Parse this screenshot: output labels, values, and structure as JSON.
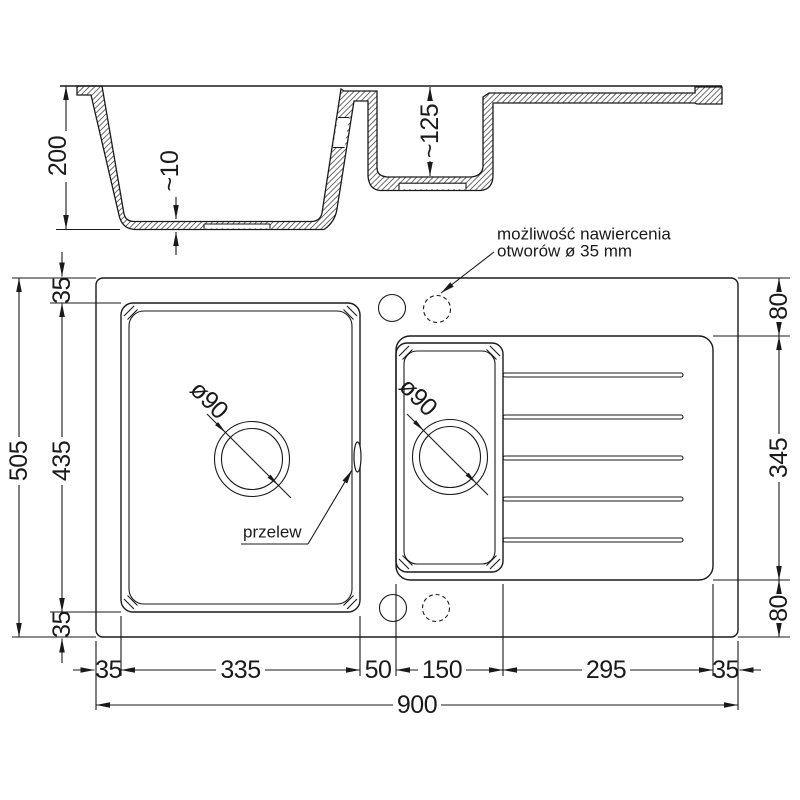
{
  "drawing_title": "sink-technical-drawing",
  "section": {
    "dim_depth": "200",
    "dim_bottom_thickness": "~10",
    "dim_small_bowl_depth": "~125",
    "note": {
      "line1": "możliwość nawiercenia",
      "line2": "otworów ø 35 mm"
    }
  },
  "plan": {
    "dim_height_total": "505",
    "dim_bowl_height": "435",
    "dim_rim_top": "35",
    "dim_rim_bottom": "35",
    "dim_right_top": "80",
    "dim_drainer_height": "345",
    "dim_right_bottom": "80",
    "dim_bottom_row": [
      "35",
      "335",
      "50",
      "150",
      "295",
      "35"
    ],
    "dim_width_total": "900",
    "label_drain_large": "ø90",
    "label_drain_small": "ø90",
    "label_overflow": "przelew"
  },
  "colors": {
    "line": "#1a1a1a",
    "background": "#ffffff"
  }
}
